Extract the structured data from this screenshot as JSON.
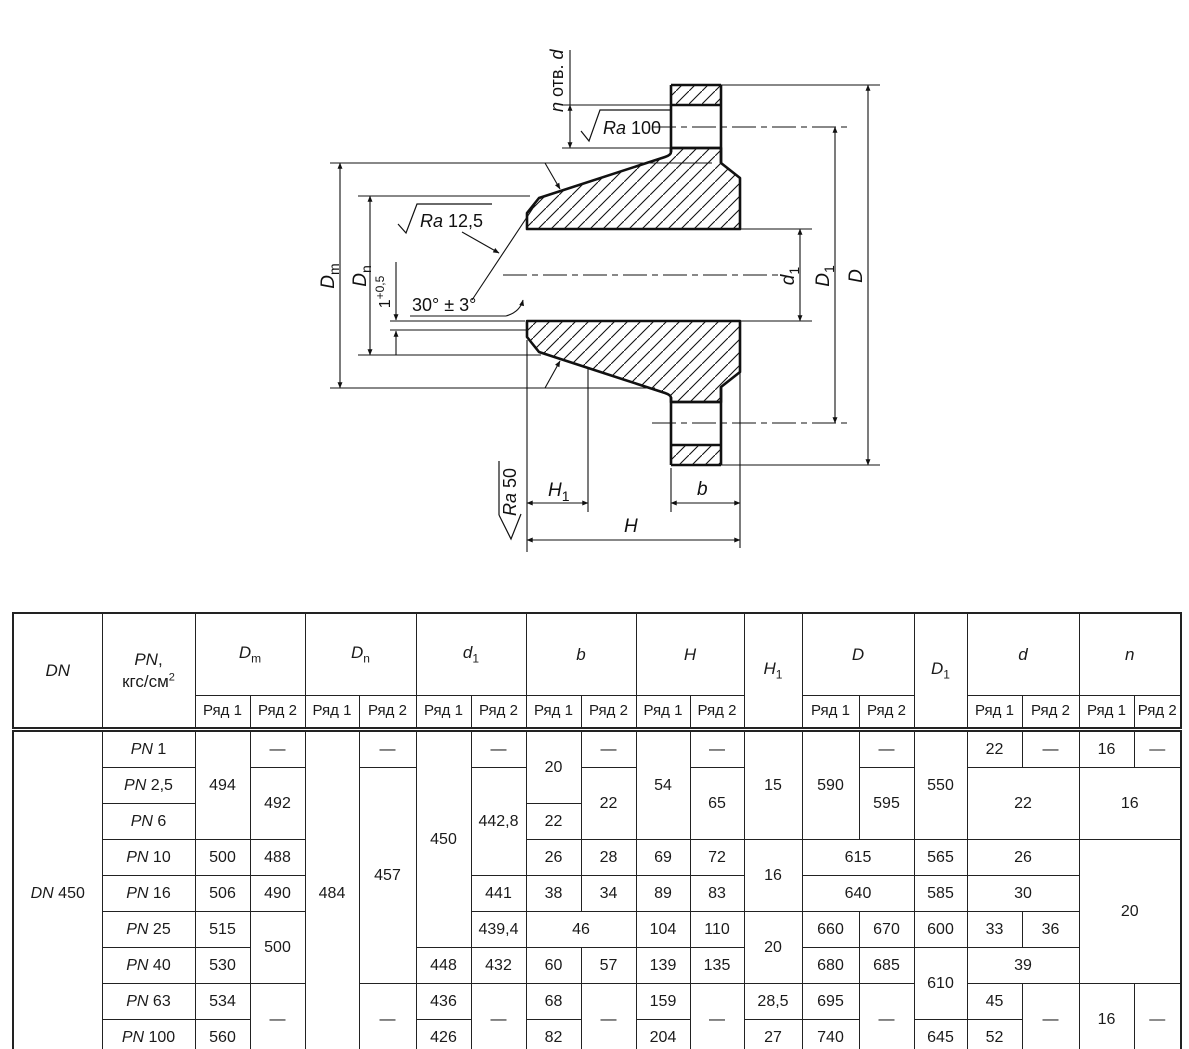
{
  "drawing": {
    "labels": {
      "holes": {
        "n": "n",
        "otv": " отв. ",
        "d": "d"
      },
      "ra100": {
        "ra": "Ra",
        "val": " 100"
      },
      "ra125": {
        "ra": "Ra",
        "val": " 12,5"
      },
      "ra50": {
        "ra": "Ra",
        "val": " 50"
      },
      "angle": "30° ± 3°",
      "land": {
        "base": "1",
        "sup": "+0,5"
      },
      "dm": {
        "m": "D",
        "s": "m"
      },
      "dn": {
        "m": "D",
        "s": "n"
      },
      "d1": {
        "m": "d",
        "s": "1"
      },
      "dd1": {
        "m": "D",
        "s": "1"
      },
      "dd": "D",
      "h1": {
        "m": "H",
        "s": "1"
      },
      "h": "H",
      "b": "b"
    }
  },
  "table": {
    "row_header": {
      "r1": "Ряд 1",
      "r2": "Ряд 2"
    },
    "headers": {
      "dn": "DN",
      "pn": {
        "sym": "PN",
        "comma": ",",
        "unit": "кгс/см",
        "sup": "2"
      },
      "dm": {
        "m": "D",
        "s": "m"
      },
      "dnn": {
        "m": "D",
        "s": "n"
      },
      "d1": {
        "m": "d",
        "s": "1"
      },
      "b": "b",
      "h": "H",
      "h1": {
        "m": "H",
        "s": "1"
      },
      "dd": "D",
      "dd1": {
        "m": "D",
        "s": "1"
      },
      "d": "d",
      "n": "n"
    },
    "body": [
      {
        "r": 0,
        "c": 0,
        "rs": 9,
        "t": "DN 450",
        "pn": true
      },
      {
        "r": 0,
        "c": 1,
        "t": "PN 1",
        "pn": true
      },
      {
        "r": 0,
        "c": 2,
        "rs": 3,
        "t": "494"
      },
      {
        "r": 0,
        "c": 3,
        "t": "—"
      },
      {
        "r": 0,
        "c": 4,
        "rs": 9,
        "t": "484"
      },
      {
        "r": 0,
        "c": 5,
        "t": "—"
      },
      {
        "r": 0,
        "c": 6,
        "rs": 6,
        "t": "450"
      },
      {
        "r": 0,
        "c": 7,
        "t": "—"
      },
      {
        "r": 0,
        "c": 8,
        "rs": 2,
        "t": "20"
      },
      {
        "r": 0,
        "c": 9,
        "t": "—"
      },
      {
        "r": 0,
        "c": 10,
        "rs": 3,
        "t": "54"
      },
      {
        "r": 0,
        "c": 11,
        "t": "—"
      },
      {
        "r": 0,
        "c": 12,
        "rs": 3,
        "t": "15"
      },
      {
        "r": 0,
        "c": 13,
        "rs": 3,
        "t": "590"
      },
      {
        "r": 0,
        "c": 14,
        "t": "—"
      },
      {
        "r": 0,
        "c": 15,
        "rs": 3,
        "t": "550"
      },
      {
        "r": 0,
        "c": 16,
        "t": "22"
      },
      {
        "r": 0,
        "c": 17,
        "t": "—"
      },
      {
        "r": 0,
        "c": 18,
        "t": "16"
      },
      {
        "r": 0,
        "c": 19,
        "t": "—"
      },
      {
        "r": 1,
        "c": 1,
        "t": "PN 2,5",
        "pn": true
      },
      {
        "r": 1,
        "c": 3,
        "rs": 2,
        "t": "492"
      },
      {
        "r": 1,
        "c": 5,
        "rs": 6,
        "t": "457"
      },
      {
        "r": 1,
        "c": 7,
        "rs": 3,
        "t": "442,8"
      },
      {
        "r": 1,
        "c": 9,
        "rs": 2,
        "t": "22"
      },
      {
        "r": 1,
        "c": 11,
        "rs": 2,
        "t": "65"
      },
      {
        "r": 1,
        "c": 14,
        "rs": 2,
        "t": "595"
      },
      {
        "r": 1,
        "c": 16,
        "rs": 2,
        "cs": 2,
        "t": "22"
      },
      {
        "r": 1,
        "c": 18,
        "rs": 2,
        "cs": 2,
        "t": "16"
      },
      {
        "r": 2,
        "c": 1,
        "t": "PN 6",
        "pn": true
      },
      {
        "r": 2,
        "c": 8,
        "t": "22"
      },
      {
        "r": 3,
        "c": 1,
        "t": "PN 10",
        "pn": true
      },
      {
        "r": 3,
        "c": 2,
        "t": "500"
      },
      {
        "r": 3,
        "c": 3,
        "t": "488"
      },
      {
        "r": 3,
        "c": 8,
        "t": "26"
      },
      {
        "r": 3,
        "c": 9,
        "t": "28"
      },
      {
        "r": 3,
        "c": 10,
        "t": "69"
      },
      {
        "r": 3,
        "c": 11,
        "t": "72"
      },
      {
        "r": 3,
        "c": 12,
        "rs": 2,
        "t": "16"
      },
      {
        "r": 3,
        "c": 13,
        "cs": 2,
        "t": "615"
      },
      {
        "r": 3,
        "c": 15,
        "t": "565"
      },
      {
        "r": 3,
        "c": 16,
        "cs": 2,
        "t": "26"
      },
      {
        "r": 3,
        "c": 18,
        "rs": 4,
        "cs": 2,
        "t": "20"
      },
      {
        "r": 4,
        "c": 1,
        "t": "PN 16",
        "pn": true
      },
      {
        "r": 4,
        "c": 2,
        "t": "506"
      },
      {
        "r": 4,
        "c": 3,
        "t": "490"
      },
      {
        "r": 4,
        "c": 7,
        "t": "441"
      },
      {
        "r": 4,
        "c": 8,
        "t": "38"
      },
      {
        "r": 4,
        "c": 9,
        "t": "34"
      },
      {
        "r": 4,
        "c": 10,
        "t": "89"
      },
      {
        "r": 4,
        "c": 11,
        "t": "83"
      },
      {
        "r": 4,
        "c": 13,
        "cs": 2,
        "t": "640"
      },
      {
        "r": 4,
        "c": 15,
        "t": "585"
      },
      {
        "r": 4,
        "c": 16,
        "cs": 2,
        "t": "30"
      },
      {
        "r": 5,
        "c": 1,
        "t": "PN 25",
        "pn": true
      },
      {
        "r": 5,
        "c": 2,
        "t": "515"
      },
      {
        "r": 5,
        "c": 3,
        "rs": 2,
        "t": "500"
      },
      {
        "r": 5,
        "c": 7,
        "t": "439,4"
      },
      {
        "r": 5,
        "c": 8,
        "cs": 2,
        "t": "46"
      },
      {
        "r": 5,
        "c": 10,
        "t": "104"
      },
      {
        "r": 5,
        "c": 11,
        "t": "110"
      },
      {
        "r": 5,
        "c": 12,
        "rs": 2,
        "t": "20"
      },
      {
        "r": 5,
        "c": 13,
        "t": "660"
      },
      {
        "r": 5,
        "c": 14,
        "t": "670"
      },
      {
        "r": 5,
        "c": 15,
        "t": "600"
      },
      {
        "r": 5,
        "c": 16,
        "t": "33"
      },
      {
        "r": 5,
        "c": 17,
        "t": "36"
      },
      {
        "r": 6,
        "c": 1,
        "t": "PN 40",
        "pn": true
      },
      {
        "r": 6,
        "c": 2,
        "t": "530"
      },
      {
        "r": 6,
        "c": 6,
        "t": "448"
      },
      {
        "r": 6,
        "c": 7,
        "t": "432"
      },
      {
        "r": 6,
        "c": 8,
        "t": "60"
      },
      {
        "r": 6,
        "c": 9,
        "t": "57"
      },
      {
        "r": 6,
        "c": 10,
        "t": "139"
      },
      {
        "r": 6,
        "c": 11,
        "t": "135"
      },
      {
        "r": 6,
        "c": 13,
        "t": "680"
      },
      {
        "r": 6,
        "c": 14,
        "t": "685"
      },
      {
        "r": 6,
        "c": 15,
        "rs": 2,
        "t": "610"
      },
      {
        "r": 6,
        "c": 16,
        "cs": 2,
        "t": "39"
      },
      {
        "r": 7,
        "c": 1,
        "t": "PN 63",
        "pn": true
      },
      {
        "r": 7,
        "c": 2,
        "t": "534"
      },
      {
        "r": 7,
        "c": 3,
        "rs": 2,
        "t": "—"
      },
      {
        "r": 7,
        "c": 5,
        "rs": 2,
        "t": "—"
      },
      {
        "r": 7,
        "c": 6,
        "t": "436"
      },
      {
        "r": 7,
        "c": 7,
        "rs": 2,
        "t": "—"
      },
      {
        "r": 7,
        "c": 8,
        "t": "68"
      },
      {
        "r": 7,
        "c": 9,
        "rs": 2,
        "t": "—"
      },
      {
        "r": 7,
        "c": 10,
        "t": "159"
      },
      {
        "r": 7,
        "c": 11,
        "rs": 2,
        "t": "—"
      },
      {
        "r": 7,
        "c": 12,
        "t": "28,5"
      },
      {
        "r": 7,
        "c": 13,
        "t": "695"
      },
      {
        "r": 7,
        "c": 14,
        "rs": 2,
        "t": "—"
      },
      {
        "r": 7,
        "c": 16,
        "t": "45"
      },
      {
        "r": 7,
        "c": 17,
        "rs": 2,
        "t": "—"
      },
      {
        "r": 7,
        "c": 18,
        "rs": 2,
        "t": "16"
      },
      {
        "r": 7,
        "c": 19,
        "rs": 2,
        "t": "—"
      },
      {
        "r": 8,
        "c": 1,
        "t": "PN 100",
        "pn": true
      },
      {
        "r": 8,
        "c": 2,
        "t": "560"
      },
      {
        "r": 8,
        "c": 6,
        "t": "426"
      },
      {
        "r": 8,
        "c": 8,
        "t": "82"
      },
      {
        "r": 8,
        "c": 10,
        "t": "204"
      },
      {
        "r": 8,
        "c": 12,
        "t": "27"
      },
      {
        "r": 8,
        "c": 13,
        "t": "740"
      },
      {
        "r": 8,
        "c": 15,
        "t": "645"
      },
      {
        "r": 8,
        "c": 16,
        "t": "52"
      }
    ]
  }
}
